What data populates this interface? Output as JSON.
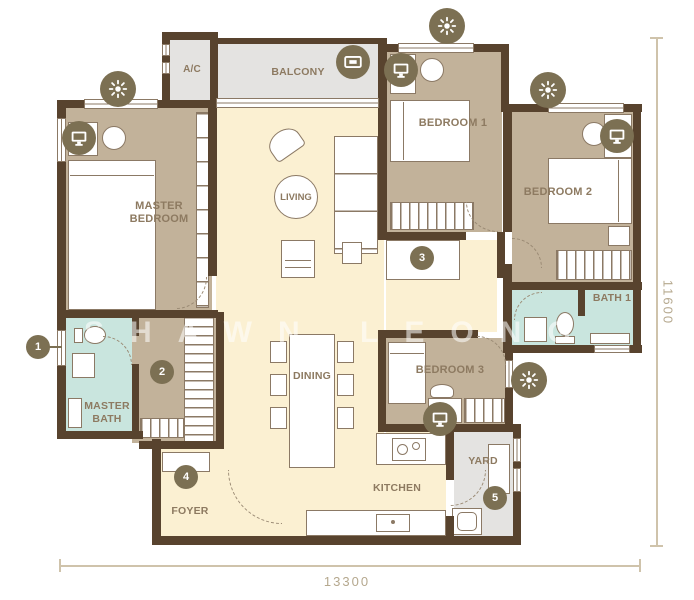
{
  "watermark": "SHAWN LEONG",
  "rooms": {
    "ac": "A/C",
    "balcony": "BALCONY",
    "master_bedroom": "MASTER BEDROOM",
    "living": "LIVING",
    "bedroom1": "BEDROOM 1",
    "bedroom2": "BEDROOM 2",
    "bedroom3": "BEDROOM 3",
    "bath1": "BATH 1",
    "master_bath": "MASTER BATH",
    "dining": "DINING",
    "kitchen": "KITCHEN",
    "foyer": "FOYER",
    "yard": "YARD"
  },
  "markers": {
    "m1": "1",
    "m2": "2",
    "m3": "3",
    "m4": "4",
    "m5": "5"
  },
  "dimensions": {
    "bottom": "13300",
    "right": "11600"
  },
  "icons": {
    "light": "ceiling-light-icon",
    "tv": "tv-icon",
    "wall_tv": "wall-tv-icon"
  },
  "colors": {
    "wall": "#58432e",
    "bedroom_floor": "#c2b29a",
    "living_floor": "#fbf0d2",
    "bath_floor": "#c9e5de",
    "outdoor_floor": "#e4e3e1",
    "icon_circle": "#7c7053",
    "label_text": "#8d7a61",
    "dimension": "#b5a88e"
  }
}
